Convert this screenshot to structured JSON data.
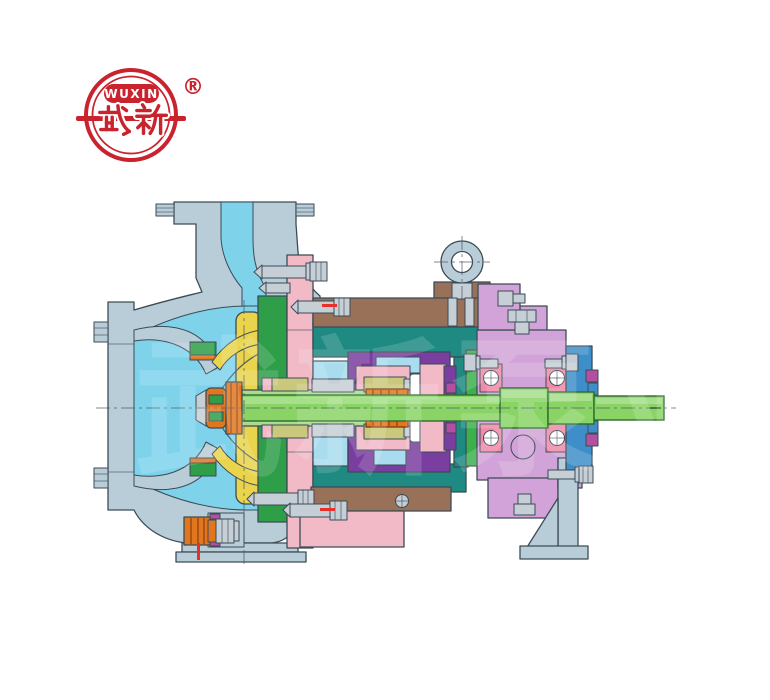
{
  "window": {
    "width": 770,
    "height": 700,
    "background": "#ffffff"
  },
  "logo": {
    "brand_latin": "WUXIN",
    "brand_cjk": "武新",
    "registered_mark": "®",
    "color": "#c9232e"
  },
  "watermark": {
    "text": "武新泵业"
  },
  "diagram": {
    "type": "centrifugal-pump-cross-section",
    "palette": {
      "outline": "#3c4b56",
      "casing": "#b9cdd9",
      "flow": "#7ed3eb",
      "flowLight": "#a9dcee",
      "impeller": "#e9d44b",
      "cover": "#2e9e49",
      "coverFlange": "#3cb04b",
      "bracket": "#1e8a82",
      "sealChamber": "#7a3da0",
      "bearingHousing": "#d2a3d8",
      "flangePink": "#f2b9c7",
      "bearingRace": "#ef8aa8",
      "lantern": "#997058",
      "shaft": "#8ad466",
      "shaftSleeve": "#a9dd8d",
      "shaftEdge": "#2f6b30",
      "bearingCover": "#3e8fc9",
      "plugOrange": "#e2761e",
      "sealRing": "#c9c87c",
      "magenta": "#b24fa0",
      "bolt": "#c6cfd6",
      "mark": "#e8302a"
    },
    "components": [
      {
        "id": "discharge-flange",
        "label": "discharge flange"
      },
      {
        "id": "pump-casing",
        "label": "volute pump casing"
      },
      {
        "id": "suction-flange",
        "label": "suction flange"
      },
      {
        "id": "flow-passage",
        "label": "flow passage"
      },
      {
        "id": "impeller",
        "label": "impeller"
      },
      {
        "id": "impeller-nut",
        "label": "impeller nut"
      },
      {
        "id": "wear-rings",
        "label": "wear rings"
      },
      {
        "id": "casing-cover",
        "label": "casing cover"
      },
      {
        "id": "cover-flange",
        "label": "cover flange"
      },
      {
        "id": "cooling-jacket",
        "label": "cooling jacket"
      },
      {
        "id": "lantern-bracket",
        "label": "lantern bracket"
      },
      {
        "id": "bearing-bracket",
        "label": "bearing bracket"
      },
      {
        "id": "seal-chamber",
        "label": "seal chamber"
      },
      {
        "id": "mechanical-seal",
        "label": "mechanical seal"
      },
      {
        "id": "shaft-sleeve",
        "label": "shaft sleeve"
      },
      {
        "id": "shaft",
        "label": "pump shaft"
      },
      {
        "id": "bearing-housing",
        "label": "bearing housing"
      },
      {
        "id": "ball-bearings",
        "label": "ball bearings"
      },
      {
        "id": "bearing-cover",
        "label": "bearing end cover"
      },
      {
        "id": "oil-plug",
        "label": "oil fill plug"
      },
      {
        "id": "drain-plugs",
        "label": "drain plugs"
      },
      {
        "id": "support-foot",
        "label": "bearing support foot"
      },
      {
        "id": "pump-foot",
        "label": "casing foot"
      },
      {
        "id": "eye-bolt",
        "label": "lifting eye bolt"
      },
      {
        "id": "fasteners",
        "label": "studs and bolts"
      }
    ]
  }
}
